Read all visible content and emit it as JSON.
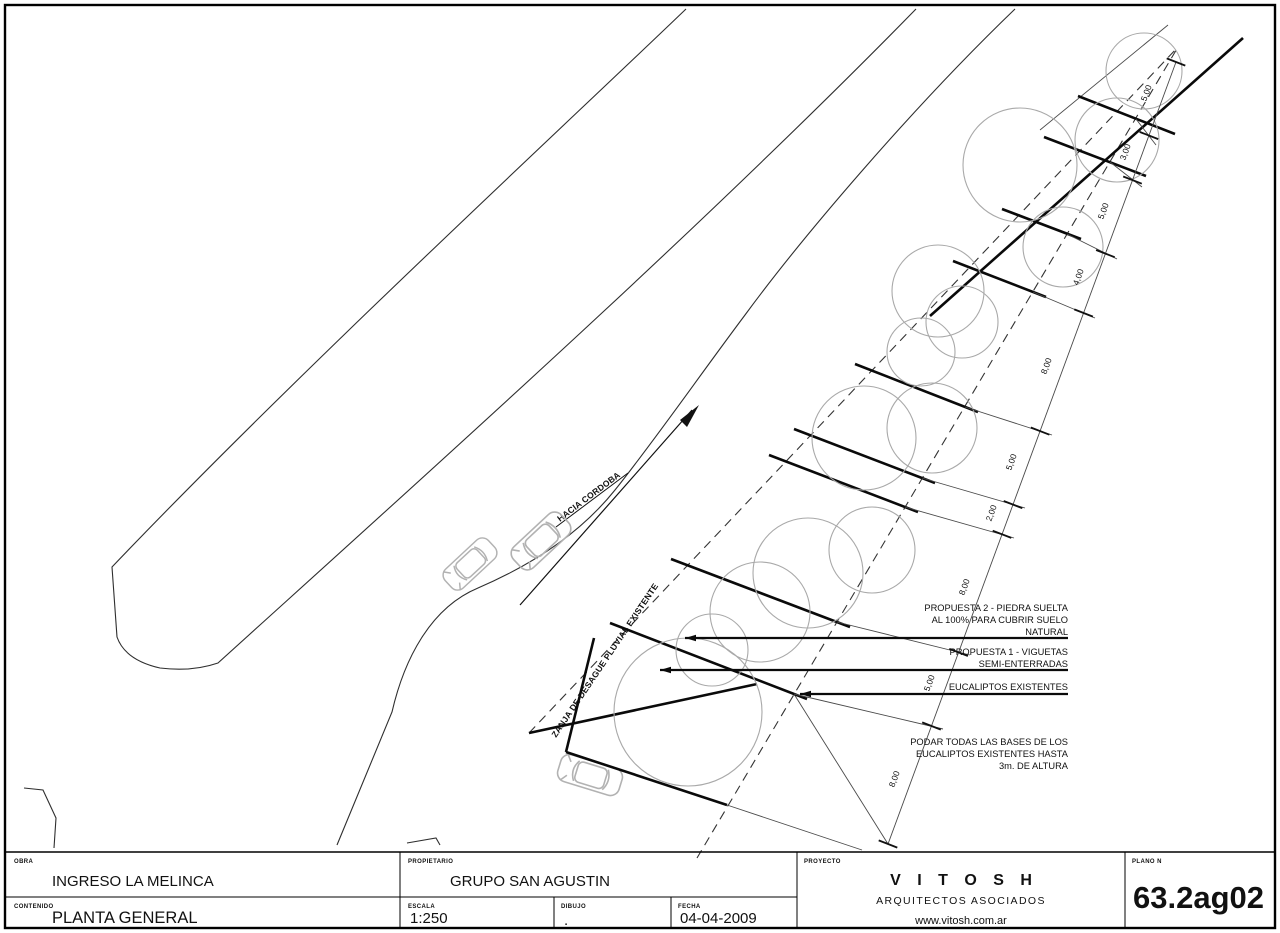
{
  "plan": {
    "road_arrow_label": "HACIA CORDOBA",
    "zanja_label": "ZANJA DE DESAGUE PLUVIAL EXISTENTE",
    "annotations": [
      {
        "lines": [
          "PROPUESTA 2 - PIEDRA SUELTA",
          "AL 100% PARA CUBRIR SUELO",
          "NATURAL"
        ],
        "leader": true
      },
      {
        "lines": [
          "PROPUESTA 1 - VIGUETAS",
          "SEMI-ENTERRADAS"
        ],
        "leader": true
      },
      {
        "lines": [
          "EUCALIPTOS EXISTENTES"
        ],
        "leader": true
      },
      {
        "lines": [
          "PODAR TODAS LAS BASES DE LOS",
          "EUCALIPTOS EXISTENTES HASTA",
          "3m. DE ALTURA"
        ],
        "leader": false
      }
    ],
    "dimensions_top_to_bottom": [
      "5,00",
      "3,00",
      "5,00",
      "4,00",
      "8,00",
      "5,00",
      "2,00",
      "8,00",
      "5,00",
      "8,00"
    ],
    "trees": [
      [
        1144,
        71,
        38
      ],
      [
        1117,
        140,
        42
      ],
      [
        1020,
        165,
        57
      ],
      [
        1063,
        247,
        40
      ],
      [
        938,
        291,
        46
      ],
      [
        962,
        322,
        36
      ],
      [
        921,
        352,
        34
      ],
      [
        932,
        428,
        45
      ],
      [
        864,
        438,
        52
      ],
      [
        872,
        550,
        43
      ],
      [
        808,
        573,
        55
      ],
      [
        760,
        612,
        50
      ],
      [
        712,
        650,
        36
      ],
      [
        688,
        712,
        74
      ]
    ],
    "colors": {
      "ink": "#111111",
      "light_gray": "#a9a9a9",
      "paper": "#ffffff"
    }
  },
  "title_block": {
    "obra": {
      "label": "OBRA",
      "value": "INGRESO LA MELINCA"
    },
    "contenido": {
      "label": "CONTENIDO",
      "value": "PLANTA GENERAL"
    },
    "propietario": {
      "label": "PROPIETARIO",
      "value": "GRUPO SAN AGUSTIN"
    },
    "escala": {
      "label": "ESCALA",
      "value": "1:250"
    },
    "dibujo": {
      "label": "DIBUJO",
      "value": "."
    },
    "fecha": {
      "label": "FECHA",
      "value": "04-04-2009"
    },
    "proyecto": {
      "label": "PROYECTO",
      "firm": "V I T O S H",
      "firm_sub": "ARQUITECTOS ASOCIADOS",
      "website": "www.vitosh.com.ar"
    },
    "plano": {
      "label": "PLANO N",
      "value": "63.2ag02"
    }
  }
}
